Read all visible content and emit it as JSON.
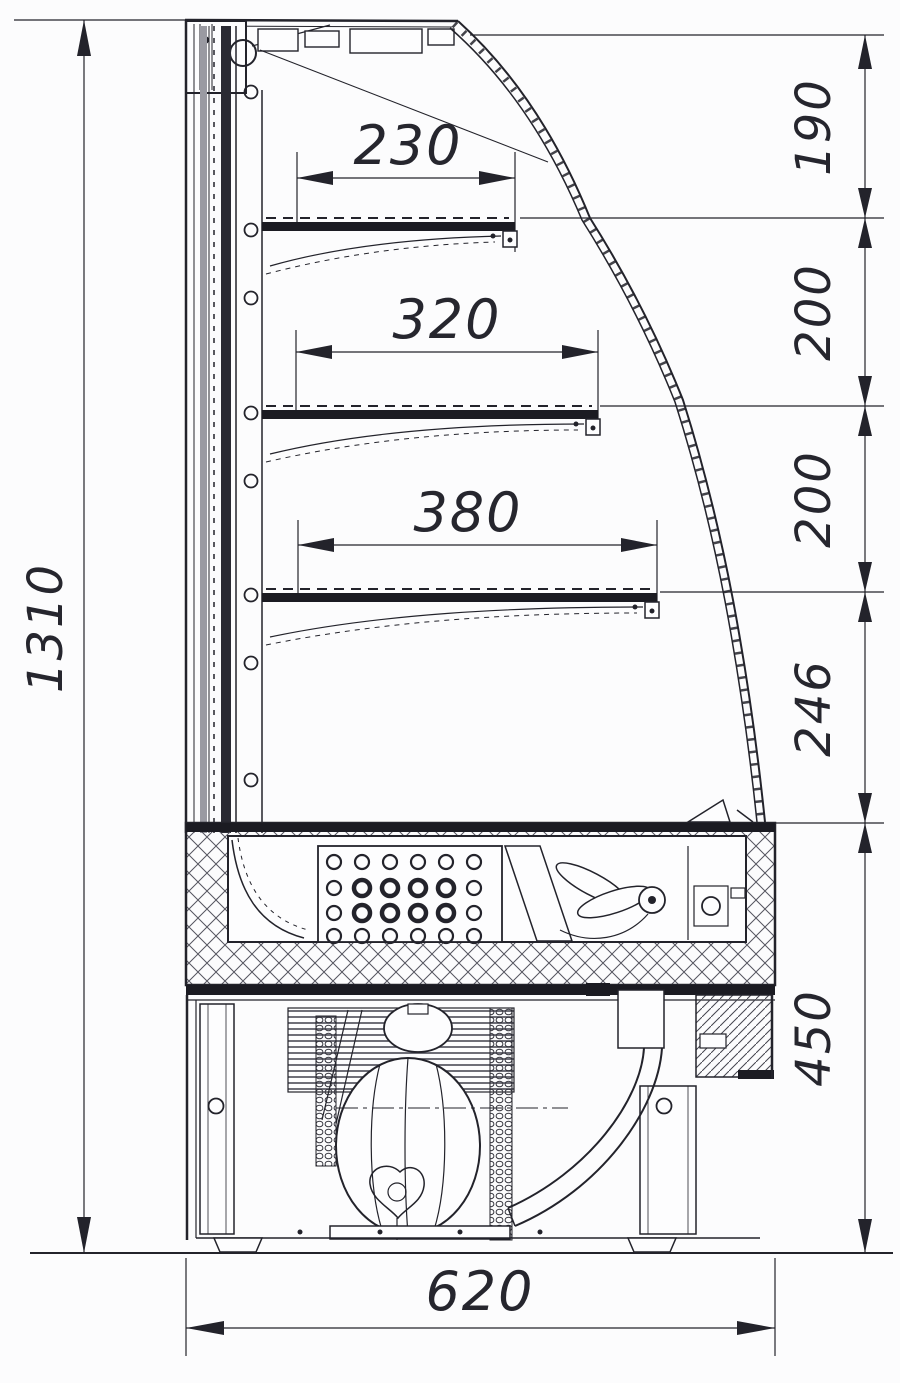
{
  "dimensions": {
    "overall_height": "1310",
    "overall_depth": "620",
    "shelf_depths": [
      "230",
      "320",
      "380"
    ],
    "right_chain": [
      "190",
      "200",
      "200",
      "246",
      "450"
    ]
  },
  "colors": {
    "line": "#23232b",
    "background": "#fcfcfd",
    "hatch": "#55555f",
    "panel_gray": "#9a9aa2",
    "panel_black": "#2a2a33"
  }
}
